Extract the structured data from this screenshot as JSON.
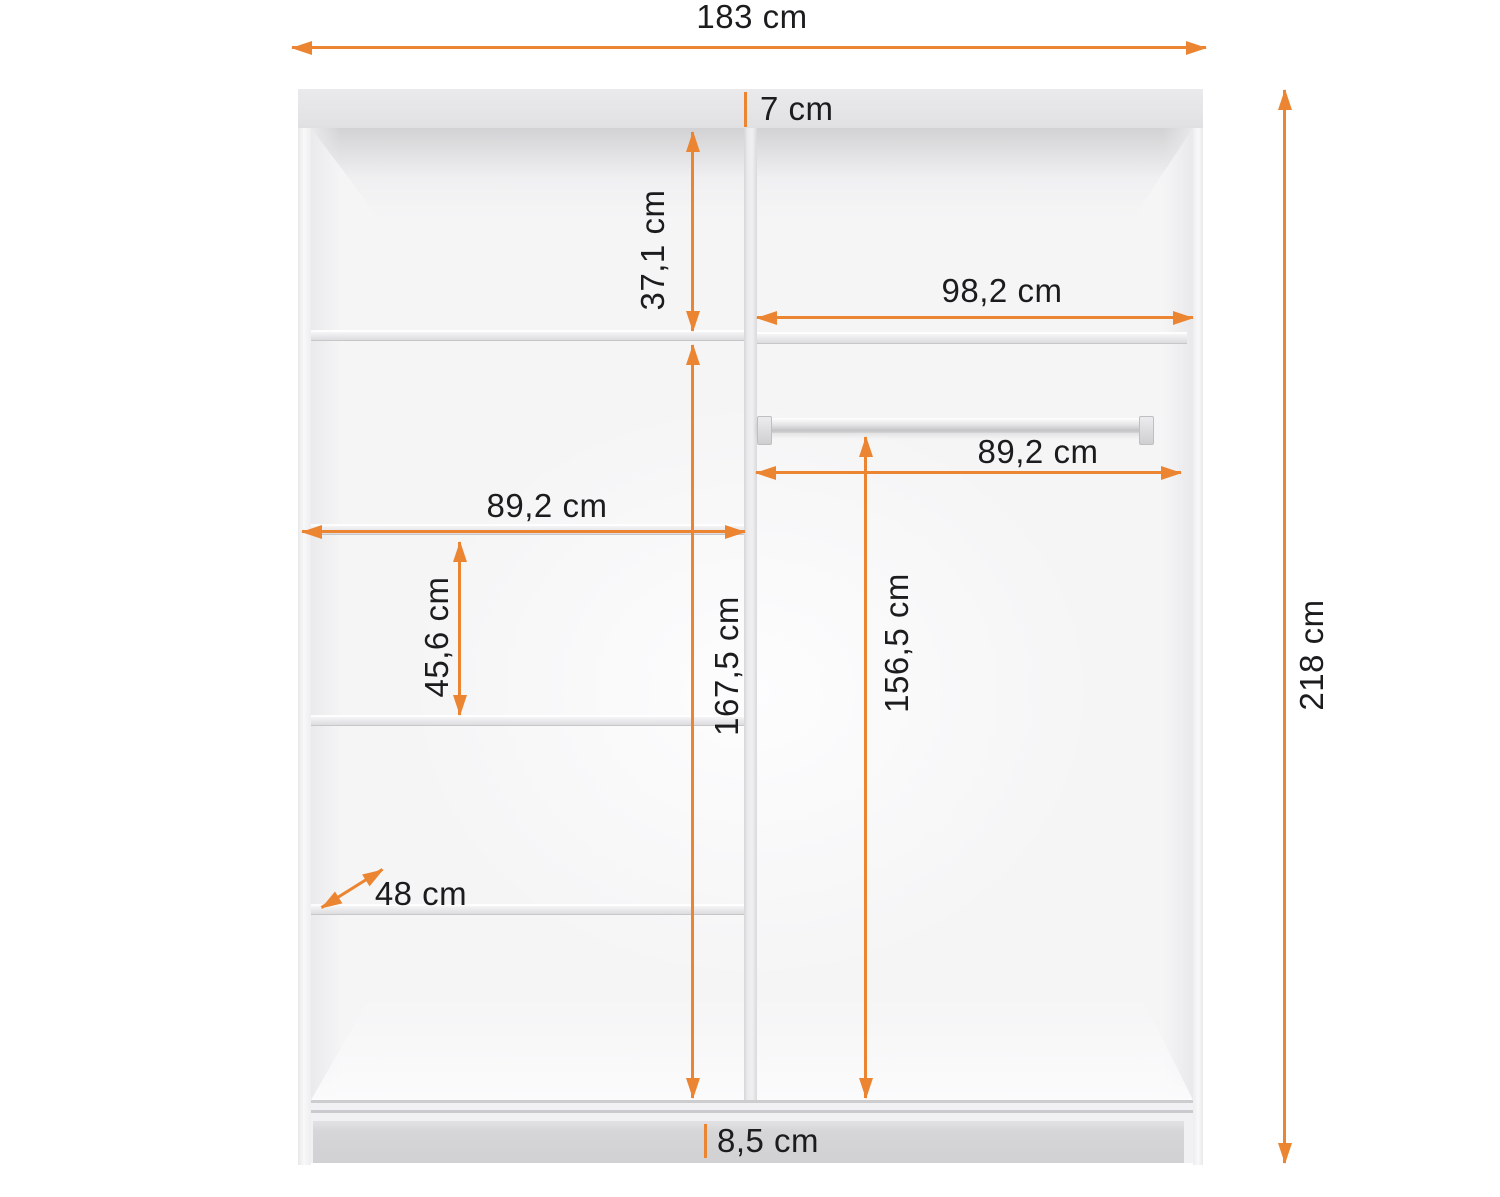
{
  "labels": {
    "total_width": "183 cm",
    "total_height": "218 cm",
    "top_panel_thickness": "7 cm",
    "upper_section_height": "37,1 cm",
    "right_upper_width": "98,2 cm",
    "rail_section_width": "89,2 cm",
    "rail_clearance_height": "156,5 cm",
    "left_shelf_width": "89,2 cm",
    "shelf_spacing": "45,6 cm",
    "left_section_height": "167,5 cm",
    "depth": "48 cm",
    "plinth_height": "8,5 cm"
  },
  "colors": {
    "accent": "#EC8532",
    "text": "#1C1C1E",
    "panel_gray": "#E6E6E8",
    "plinth_gray": "#D4D4D6",
    "background": "#FFFFFF"
  }
}
